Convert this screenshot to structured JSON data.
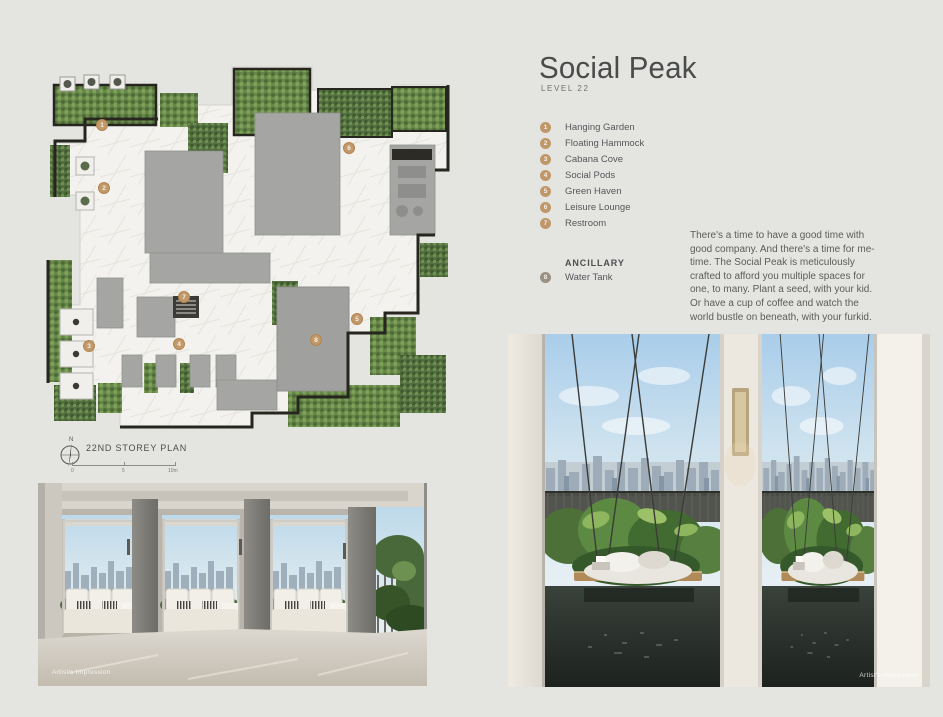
{
  "header": {
    "title": "Social Peak",
    "subtitle": "LEVEL 22"
  },
  "legend": {
    "items": [
      {
        "number": "1",
        "label": "Hanging Garden"
      },
      {
        "number": "2",
        "label": "Floating Hammock"
      },
      {
        "number": "3",
        "label": "Cabana Cove"
      },
      {
        "number": "4",
        "label": "Social Pods"
      },
      {
        "number": "5",
        "label": "Green Haven"
      },
      {
        "number": "6",
        "label": "Leisure Lounge"
      },
      {
        "number": "7",
        "label": "Restroom"
      }
    ],
    "ancillary": {
      "heading": "ANCILLARY",
      "items": [
        {
          "number": "8",
          "label": "Water Tank"
        }
      ]
    }
  },
  "description": "There's a time to have a good time with good company. And there's a time for me-time. The Social Peak is meticulously crafted to afford you multiple spaces for one, to many. Plant a seed, with your kid. Or have a cup of coffee and watch the world bustle on beneath, with your furkid.",
  "plan": {
    "caption": "22ND STOREY PLAN",
    "compass_label": "N",
    "scale_labels": [
      "0",
      "5",
      "10m"
    ],
    "markers": [
      {
        "number": "1",
        "x": 62,
        "y": 60
      },
      {
        "number": "2",
        "x": 64,
        "y": 123
      },
      {
        "number": "3",
        "x": 49,
        "y": 281
      },
      {
        "number": "4",
        "x": 139,
        "y": 279
      },
      {
        "number": "5",
        "x": 317,
        "y": 254
      },
      {
        "number": "6",
        "x": 309,
        "y": 83
      },
      {
        "number": "7",
        "x": 144,
        "y": 232
      },
      {
        "number": "8",
        "x": 276,
        "y": 275
      }
    ]
  },
  "images": {
    "cabana": {
      "caption": "Artist's Impression"
    },
    "hammock": {
      "caption": "Artist's Impression"
    }
  },
  "colors": {
    "background": "#e4e5e1",
    "marker_accent": "#bf9768",
    "ancillary_marker": "#9a9084",
    "text": "#55575a"
  }
}
